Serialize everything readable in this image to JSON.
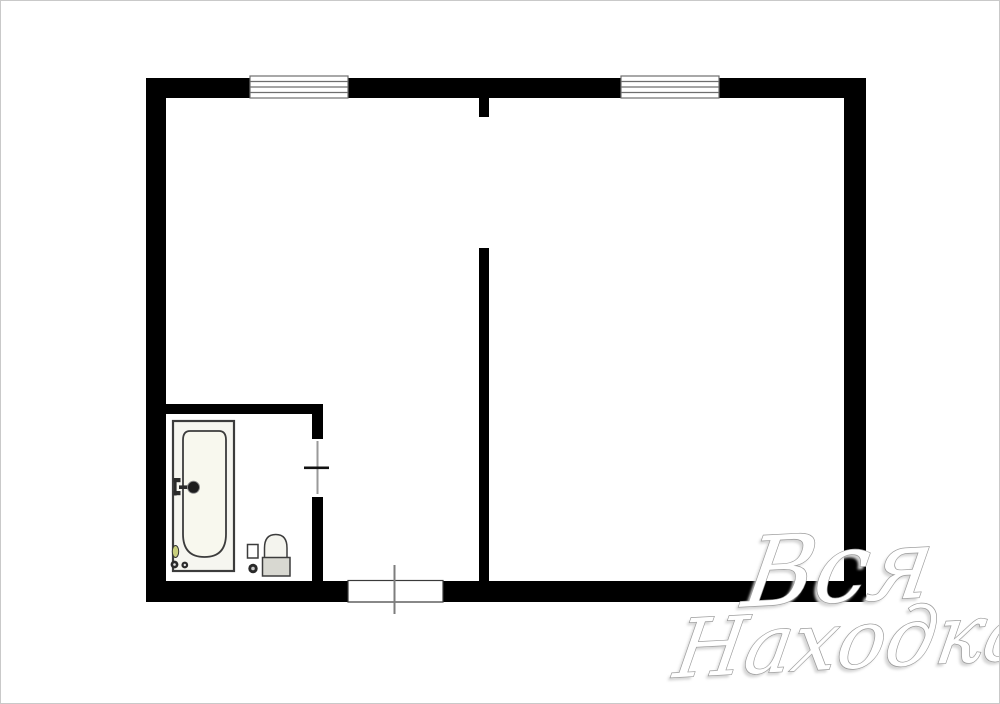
{
  "page": {
    "background": "#ffffff",
    "border_color": "#c9c9c9",
    "type_label": "apartment floor plan"
  },
  "colors": {
    "wall": "#000000",
    "window_frame": "#6e6e6e",
    "door_marker": "#7d7d7d",
    "door_tick": "#111111",
    "bathtub_fill": "#f6f6f0",
    "bathtub_inner_fill": "#f8f8ee",
    "fixture_stroke": "#3c3c3c",
    "toilet_tank_gray": "#d8d8d1",
    "toilet_bowl_fill": "#f4f4ee",
    "soap_dish_yellow": "#c9cf7c",
    "drain_dark": "#2a2a2a"
  },
  "watermark": {
    "line1": "Вся",
    "line2": "Находка",
    "fill_color": "#ffffff",
    "outline_color": "#9a9a9a",
    "shadow_color": "#d6d6d6"
  }
}
